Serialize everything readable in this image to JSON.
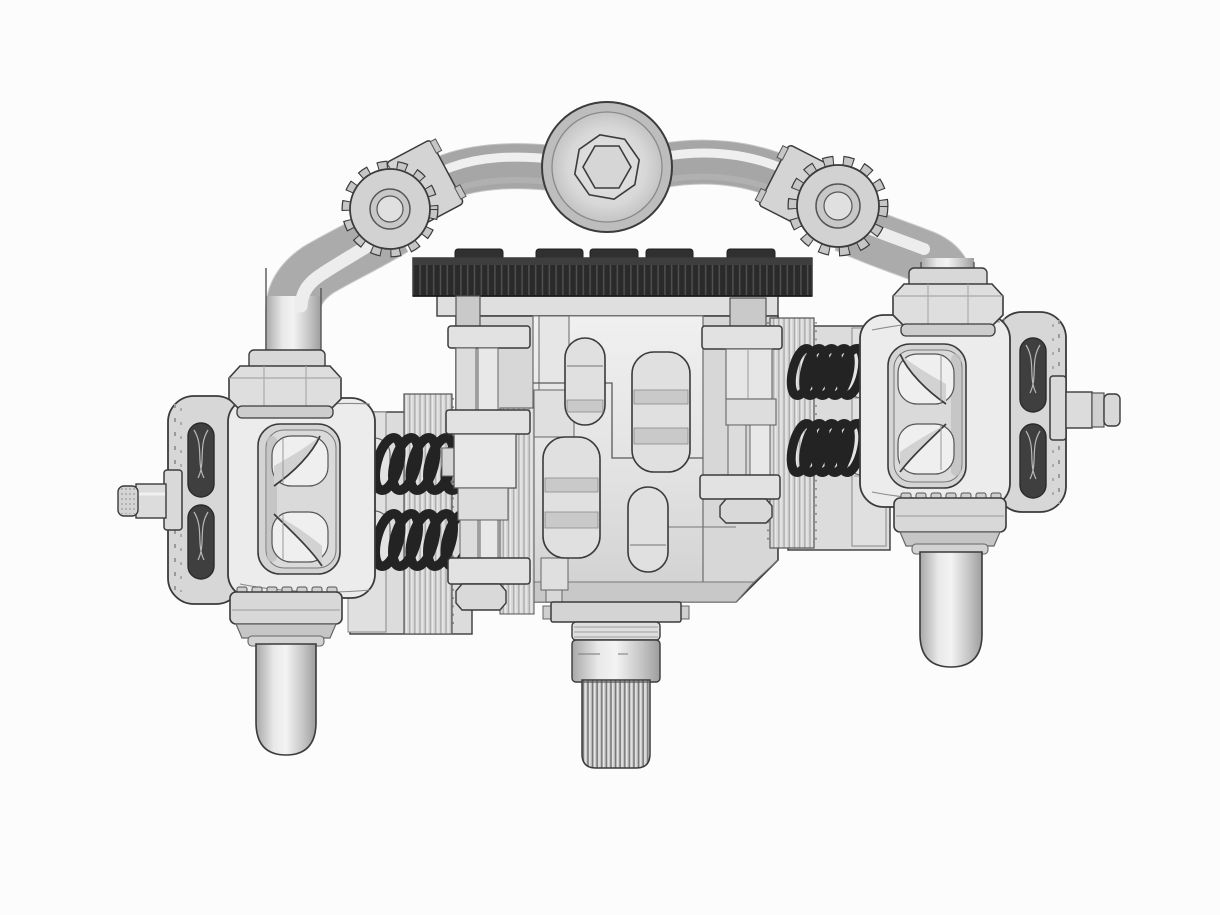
{
  "meta": {
    "title": "3D CAD render of a horizontally opposed twin-cylinder model engine, front view on white background",
    "view": "front shaded orthographic-style view",
    "text_content": "none (image contains no visible text)"
  },
  "palette": {
    "background": "#fcfcfc",
    "outline": "#3b3b3b",
    "metal_bright": "#f2f2f2",
    "metal_light": "#ececec",
    "metal_mid": "#d6d6d6",
    "metal_dark": "#bfbfbf",
    "metal_shadow": "#a6a6a6",
    "gear_dark": "#2a2a2a",
    "gear_stripe": "#525252",
    "gear_top": "#3e3e3e",
    "spring_dark": "#232323",
    "slot_dark": "#3f3f3f",
    "window_fill": "#e0e0e0"
  },
  "components": [
    {
      "id": "hex-socket-cap",
      "label": "Central hex-socket cap fitting"
    },
    {
      "id": "fuel-line-left",
      "label": "Upper manifold pipe, left run"
    },
    {
      "id": "fuel-line-right",
      "label": "Upper manifold pipe, right run"
    },
    {
      "id": "banjo-fitting-left",
      "label": "Knurled banjo fitting at left elbow"
    },
    {
      "id": "banjo-fitting-right",
      "label": "Knurled banjo fitting at right elbow"
    },
    {
      "id": "union-nut-left",
      "label": "Hex union nut on left rocker cover"
    },
    {
      "id": "union-nut-right",
      "label": "Hex union nut on right rocker cover"
    },
    {
      "id": "timing-gear",
      "label": "Dark spur gear on crankcase top"
    },
    {
      "id": "crankcase",
      "label": "Central crankcase with four relief windows"
    },
    {
      "id": "pushrod-guide-left",
      "label": "Left pushrod and guide clamps"
    },
    {
      "id": "pushrod-guide-right",
      "label": "Right pushrod and guide clamps"
    },
    {
      "id": "valve-springs-left",
      "label": "Two black valve springs, left cylinder"
    },
    {
      "id": "valve-springs-right",
      "label": "Two black valve springs, right cylinder"
    },
    {
      "id": "cylinder-fins-left",
      "label": "Left cylinder finned barrel"
    },
    {
      "id": "cylinder-fins-right",
      "label": "Right cylinder finned barrel"
    },
    {
      "id": "rocker-cover-left",
      "label": "Left rocker box with window and rocker arms"
    },
    {
      "id": "rocker-cover-right",
      "label": "Right rocker box with window and rocker arms"
    },
    {
      "id": "head-plate-left",
      "label": "Left cylinder head end plate with dark ports"
    },
    {
      "id": "head-plate-right",
      "label": "Right cylinder head end plate with dark ports"
    },
    {
      "id": "crank-stub-left",
      "label": "Left threaded stub shaft"
    },
    {
      "id": "crank-stub-right",
      "label": "Right threaded stub shaft"
    },
    {
      "id": "exhaust-stub-left",
      "label": "Left downward exhaust stub with castellated nut"
    },
    {
      "id": "exhaust-stub-right",
      "label": "Right downward exhaust stub with castellated nut"
    },
    {
      "id": "output-spline-shaft",
      "label": "Bottom splined output shaft"
    }
  ]
}
